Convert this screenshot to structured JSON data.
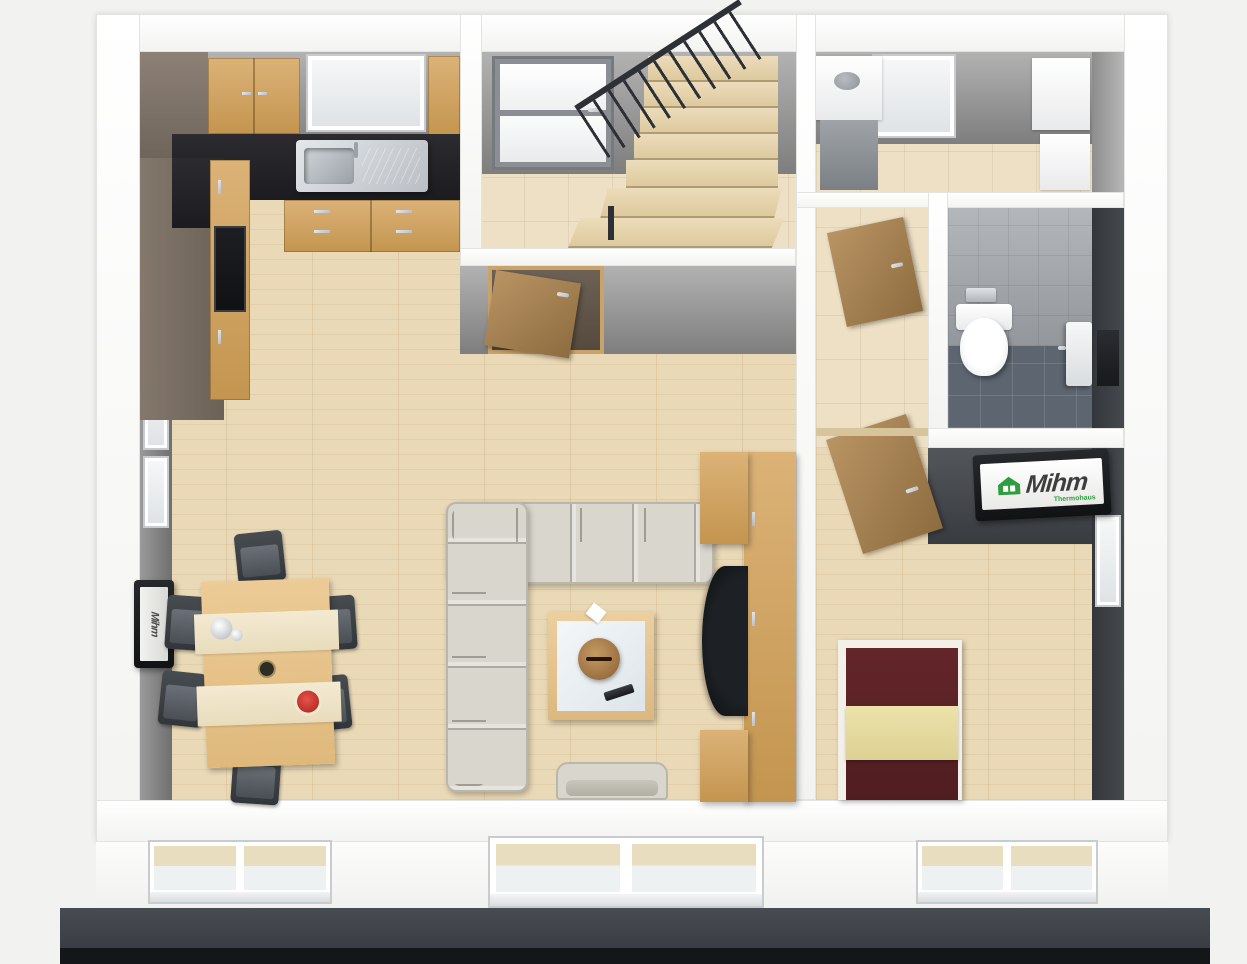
{
  "brand": {
    "name": "Mihm",
    "subtitle": "Thermohaus",
    "accent_green": "#2f9e41",
    "text_color": "#3c3f3e"
  },
  "scene": {
    "kind": "3d-birdseye-floorplan-render",
    "rooms": [
      {
        "name": "kitchen"
      },
      {
        "name": "entrance-hall"
      },
      {
        "name": "utility-room"
      },
      {
        "name": "guest-wc"
      },
      {
        "name": "living-dining-room"
      },
      {
        "name": "corridor"
      },
      {
        "name": "bedroom"
      }
    ],
    "furniture": [
      "kitchen-cabinets",
      "kitchen-sink",
      "oven-column",
      "dining-table",
      "dining-chairs",
      "corner-sofa",
      "armchair",
      "coffee-table",
      "wooden-bowl",
      "remote-control",
      "tv-lowboard",
      "tv",
      "wall-mounted-tv",
      "bed",
      "toilet",
      "washbasin",
      "boiler",
      "staircase",
      "front-door",
      "interior-doors",
      "terrace-door",
      "windows"
    ]
  },
  "palette": {
    "exterior_wall": "#fafafa",
    "interior_wall": "#8f8f8f",
    "accent_wall": "#3d4145",
    "parquet": "#ead9b6",
    "hall_tile": "#eee0c5",
    "wc_floor": "#5d6571",
    "wood_furniture": "#d3a86b",
    "countertop": "#232327",
    "sofa": "#d9d6cd",
    "bed_cover": "#5c2327",
    "bed_blanket": "#eae0a8",
    "plinth": "#3f444a",
    "base_strip": "#15171a"
  }
}
